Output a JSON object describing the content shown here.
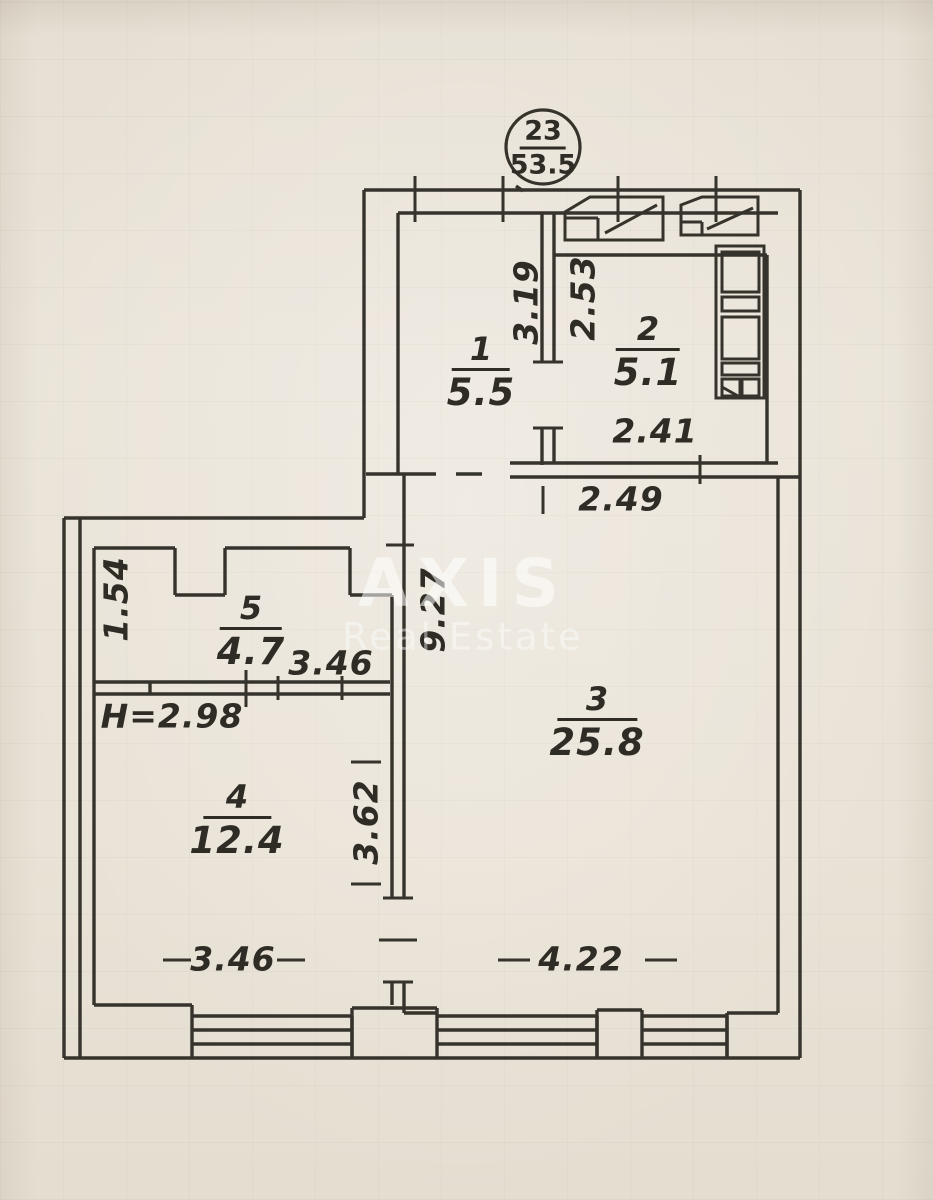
{
  "badge": {
    "apartment_number": "23",
    "total_area": "53.5"
  },
  "watermark": {
    "brand": "AXIS",
    "tagline": "Real Estate"
  },
  "rooms": {
    "r1": {
      "number": "1",
      "area": "5.5"
    },
    "r2": {
      "number": "2",
      "area": "5.1"
    },
    "r3": {
      "number": "3",
      "area": "25.8"
    },
    "r4": {
      "number": "4",
      "area": "12.4"
    },
    "r5": {
      "number": "5",
      "area": "4.7"
    }
  },
  "dims": {
    "hallway_depth": "3.19",
    "kitchen_depth": "2.53",
    "kitchen_width": "2.41",
    "living_top_width": "2.49",
    "living_depth": "9.27",
    "closet_side": "1.54",
    "closet_width": "3.46",
    "ceiling_height": "H=2.98",
    "bedroom_depth": "3.62",
    "bedroom_width": "3.46",
    "living_bottom_width": "4.22"
  }
}
